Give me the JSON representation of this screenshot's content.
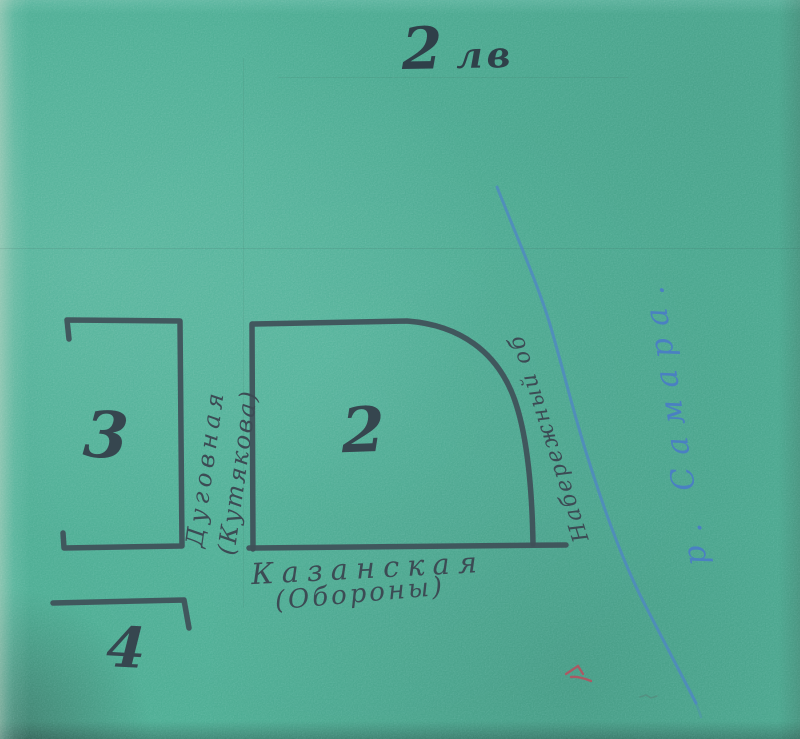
{
  "title": {
    "number": "2",
    "suffix": "лв"
  },
  "map": {
    "blocks": [
      {
        "id": "block-3",
        "number": "3"
      },
      {
        "id": "block-2",
        "number": "2"
      },
      {
        "id": "block-4",
        "number": "4"
      }
    ],
    "streets": {
      "vertical_name": "Дуговная",
      "vertical_alt": "(Кутякова)",
      "bottom_name": "Казанская",
      "bottom_alt": "(Обороны)",
      "diagonal_name": "Набережный об"
    },
    "river_label": "р. Самара."
  },
  "colors": {
    "paper": "#6dc0ac",
    "ink": "#3c4d55",
    "river_blue": "#4a80c2",
    "red_mark": "#c0485a"
  }
}
